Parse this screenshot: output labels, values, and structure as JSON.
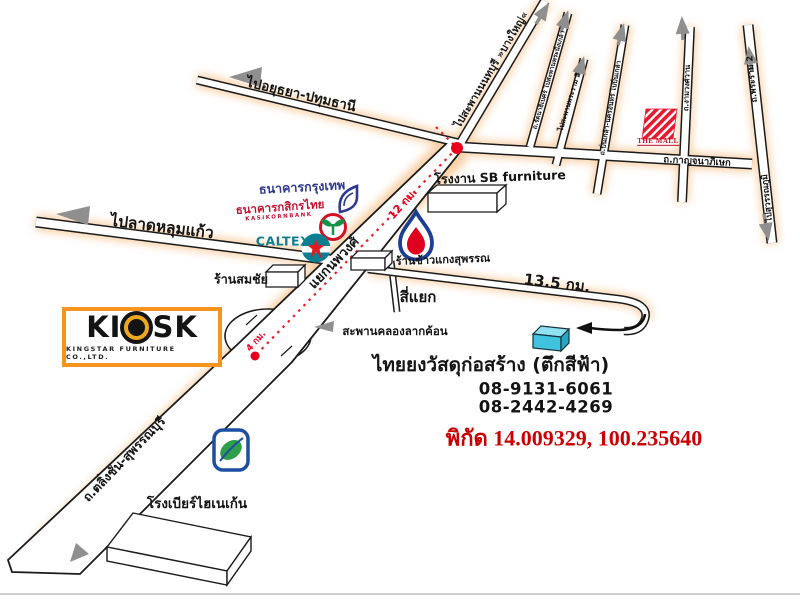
{
  "roads": {
    "to_ayutthaya": "ไปอยุธยา-ปทุมธานี",
    "to_nonthaburi_bridge": "ไปสะพานนนทบุรี »บางใหญ่«",
    "rattanathibet": "ถ.รัตนาธิเบศร์ ไปสะพานพระนั่งเกล้า",
    "to_rama5_bridge": "ไปสะพานพระราม 5",
    "pinklao_nakhon_in": "ถ.ปิ่นเกล้า-นครอินทร์ ไปปิ่นเกล้า",
    "ngamwongwan": "ถ.งามวงศ์วาน",
    "kanchanaphisek": "ถ.กาญจนาภิเษก",
    "rama2": "ถ.พระราม 2",
    "to_suvarnabhumi": "ไปสุวรรณภูมิ",
    "to_lat_lum_kaeo": "ไปลาดหลุมแก้ว",
    "talingchan_suphanburi": "ถ.ตลิ่งชัน-สุพรรณบุรี"
  },
  "junctions": {
    "noppawong": "แยกนพวงศ์",
    "si_yaek": "สี่แยก",
    "lak_khon_bridge": "สะพานคลองลากค้อน"
  },
  "distances": {
    "route_12km": "12 กม.",
    "route_4km": "4 กม.",
    "side_13_5km": "13.5 กม."
  },
  "places": {
    "bangkok_bank": "ธนาคารกรุงเทพ",
    "kasikorn_bank": "ธนาคารกสิกรไทย",
    "kasikorn_en": "KASIKORNBANK",
    "caltex": "CALTEX",
    "somchai_shop": "ร้านสมชัย",
    "sb_factory": "โรงงาน SB furniture",
    "rice_shop": "ร้านข้าวแกงสุพรรณ",
    "the_mall": "THE MALL",
    "heineken_brewery": "โรงเบียร์ไฮเนเก้น"
  },
  "destination": {
    "name": "ไทยยงวัสดุก่อสร้าง (ตึกสีฟ้า)",
    "phone_1": "08-9131-6061",
    "phone_2": "08-2442-4269",
    "coordinates": "พิกัด 14.009329, 100.235640"
  },
  "company_logo": {
    "name": "KIOSK",
    "name_left": "KI",
    "name_right": "SK",
    "subtitle": "KINGSTAR FURNITURE CO.,LTD."
  },
  "colors": {
    "route_red": "#e8001c",
    "road_glow": "#f7c38d",
    "coordinates_text": "#cc0000",
    "mall_red": "#e8192c",
    "caltex_teal": "#0d7f91",
    "bangkok_bank_navy": "#2b3990",
    "kasikorn_red": "#c41230",
    "kasikorn_green": "#13934a",
    "ptt_blue": "#1c3f94",
    "ptt_red": "#e0001d",
    "destination_building_blue": "#3fc3de",
    "kiosk_orange": "#f5941f",
    "heineken_blue": "#1d4fa1",
    "heineken_green": "#2f9e49"
  }
}
